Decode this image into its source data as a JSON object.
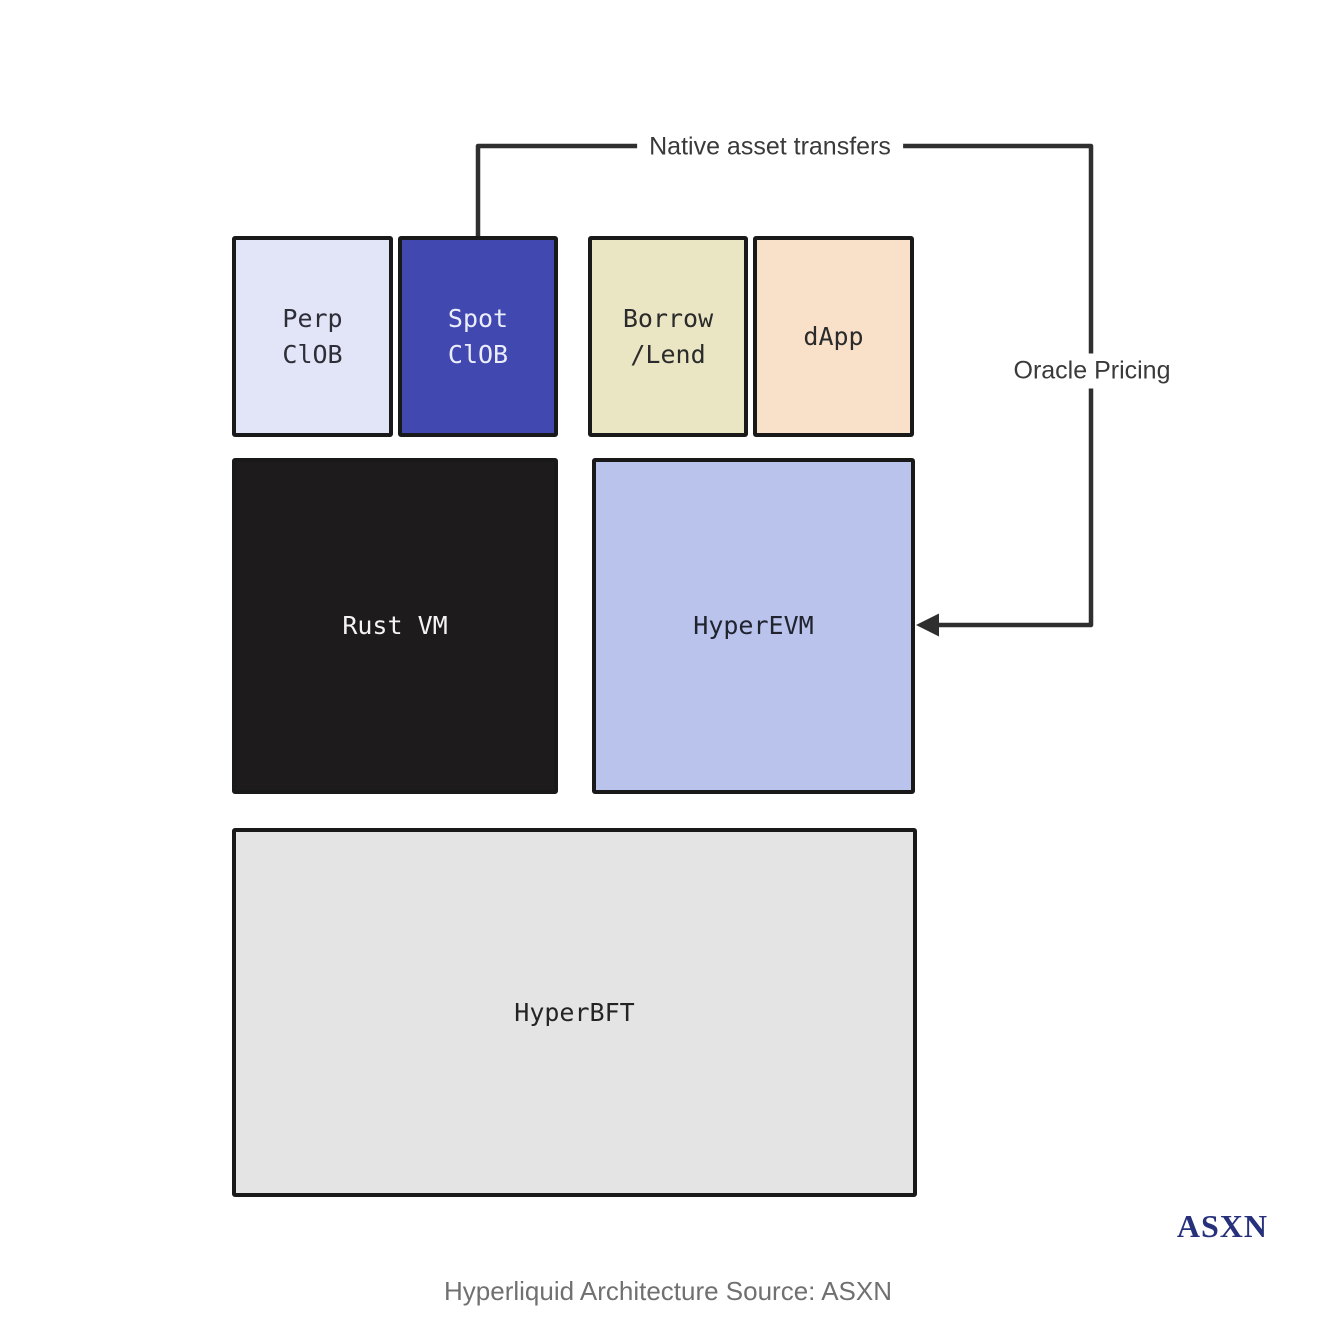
{
  "diagram": {
    "title_caption": "Hyperliquid Architecture Source: ASXN",
    "logo_text": "ASXN",
    "boxes": [
      {
        "id": "perp-clob",
        "label": "Perp\nClOB",
        "bg": "#e2e4f7",
        "fg": "#2e2e38"
      },
      {
        "id": "spot-clob",
        "label": "Spot\nClOB",
        "bg": "#4149b0",
        "fg": "#eceefb"
      },
      {
        "id": "borrow-lend",
        "label": "Borrow\n/Lend",
        "bg": "#eae6c3",
        "fg": "#2b2b2b"
      },
      {
        "id": "dapp",
        "label": "dApp",
        "bg": "#f9e0c9",
        "fg": "#2b2b2b"
      },
      {
        "id": "rust-vm",
        "label": "Rust VM",
        "bg": "#1d1b1b",
        "fg": "#f4f4f4"
      },
      {
        "id": "hyperevm",
        "label": "HyperEVM",
        "bg": "#b9c3ec",
        "fg": "#20242e"
      },
      {
        "id": "hyperbft",
        "label": "HyperBFT",
        "bg": "#e4e4e4",
        "fg": "#242424"
      }
    ],
    "connectors": [
      {
        "id": "native-asset-transfers",
        "label": "Native asset transfers",
        "from": "spot-clob",
        "to": "hyperevm"
      },
      {
        "id": "oracle-pricing",
        "label": "Oracle Pricing",
        "direction": "arrow-into-hyperevm"
      }
    ],
    "line_color": "#2f2f2f"
  }
}
